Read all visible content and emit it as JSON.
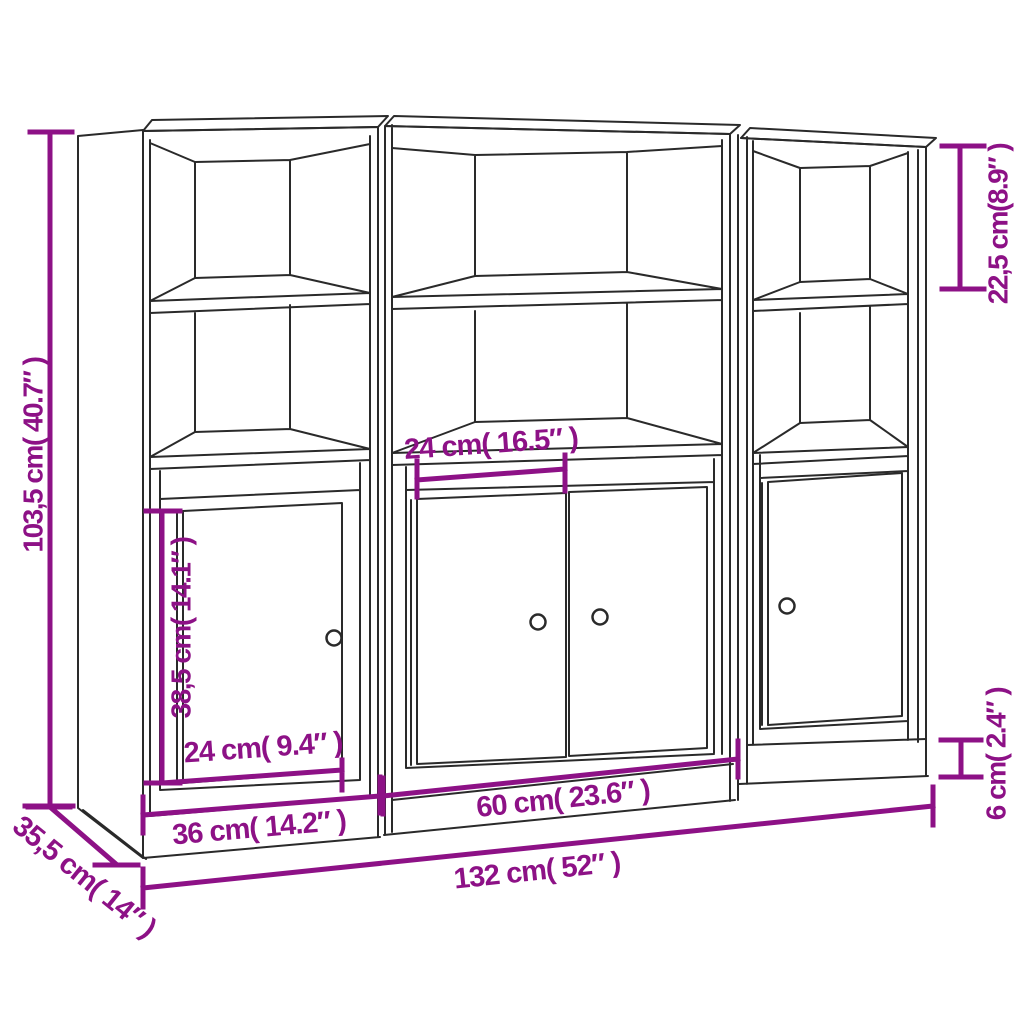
{
  "page": {
    "background": "#ffffff",
    "accent_color": "#8d1186",
    "line_color": "#2a2a2a"
  },
  "diagram": {
    "subject": "three-piece highboard with open shelves and doors",
    "units": "cm and inches",
    "dimensions": [
      {
        "id": "overall-height",
        "label": "103,5 cm( 40.7″ )",
        "orientation": "vertical"
      },
      {
        "id": "top-compartment-height",
        "label": "22,5 cm(8.9″ )",
        "orientation": "vertical"
      },
      {
        "id": "middle-door-width",
        "label": "24 cm( 16.5″ )",
        "orientation": "horizontal"
      },
      {
        "id": "side-door-height",
        "label": "38,5 cm( 14.1″ )",
        "orientation": "vertical"
      },
      {
        "id": "side-door-width",
        "label": "24 cm( 9.4″ )",
        "orientation": "horizontal"
      },
      {
        "id": "side-unit-width",
        "label": "36 cm( 14.2″ )",
        "orientation": "horizontal"
      },
      {
        "id": "middle-unit-width",
        "label": "60 cm( 23.6″ )",
        "orientation": "horizontal"
      },
      {
        "id": "overall-width",
        "label": "132 cm( 52″ )",
        "orientation": "horizontal"
      },
      {
        "id": "depth",
        "label": "35,5 cm( 14″ )",
        "orientation": "diagonal"
      },
      {
        "id": "plinth-height",
        "label": "6 cm( 2.4″ )",
        "orientation": "vertical"
      }
    ]
  }
}
